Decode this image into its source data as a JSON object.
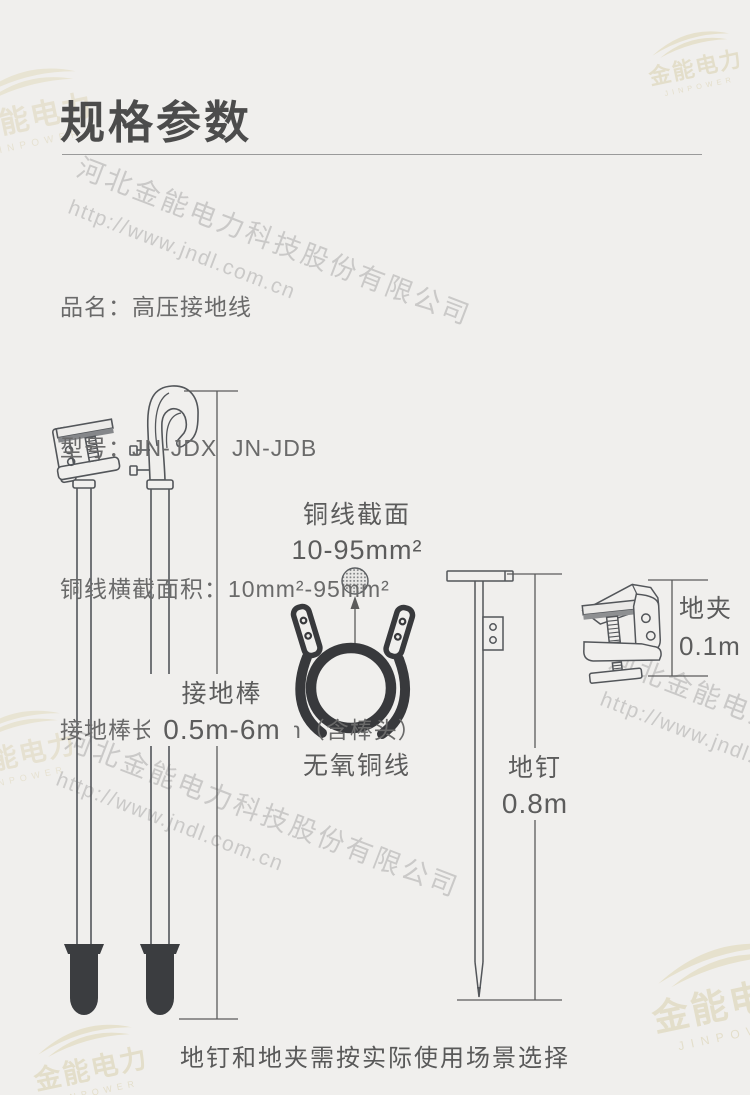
{
  "header": {
    "title": "规格参数"
  },
  "specs": [
    "品名：高压接地线",
    "型号：JN-JDX  JN-JDB",
    "铜线横截面积：10mm²-95mm²",
    "接地棒长度：0.5m-6m（含棒头）"
  ],
  "diagram": {
    "rod": {
      "name": "接地棒",
      "length": "0.5m-6m"
    },
    "copper_section": {
      "name": "铜线截面",
      "area": "10-95mm²"
    },
    "wire": {
      "name": "无氧铜线"
    },
    "nail": {
      "name": "地钉",
      "length": "0.8m"
    },
    "clamp": {
      "name": "地夹",
      "length": "0.1m"
    }
  },
  "footer": {
    "note": "地钉和地夹需按实际使用场景选择"
  },
  "watermark": {
    "company": "河北金能电力科技股份有限公司",
    "url": "http://www.jndl.com.cn",
    "logo_cn": "金能电力",
    "logo_en": "JINPOWER"
  },
  "colors": {
    "background": "#f0efed",
    "title_text": "#4c4c4c",
    "body_text": "#6a6a6a",
    "line_art": "#53565a",
    "dark_fill": "#3b3d40",
    "watermark_beige": "#d8cea8"
  }
}
